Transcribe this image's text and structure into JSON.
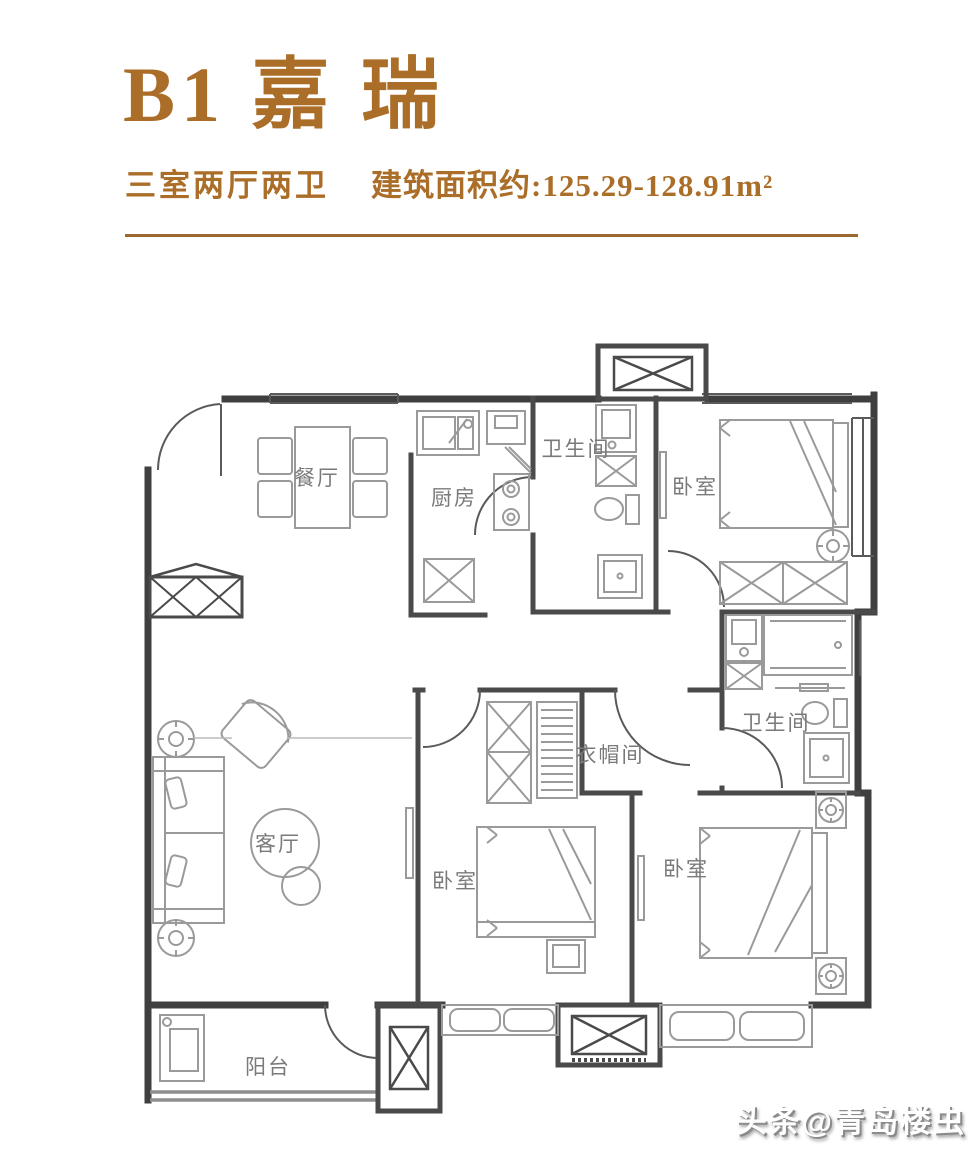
{
  "header": {
    "title": "B1 嘉 瑞",
    "layout_spec": "三室两厅两卫",
    "area_text": "建筑面积约:125.29-128.91m²"
  },
  "floorplan": {
    "rooms": [
      {
        "id": "dining",
        "label": "餐厅"
      },
      {
        "id": "kitchen",
        "label": "厨房"
      },
      {
        "id": "bathroom-1",
        "label": "卫生间"
      },
      {
        "id": "bedroom-1",
        "label": "卧室"
      },
      {
        "id": "living",
        "label": "客厅"
      },
      {
        "id": "closet",
        "label": "衣帽间"
      },
      {
        "id": "bathroom-2",
        "label": "卫生间"
      },
      {
        "id": "bedroom-2",
        "label": "卧室"
      },
      {
        "id": "bedroom-3",
        "label": "卧室"
      },
      {
        "id": "balcony",
        "label": "阳台"
      }
    ]
  },
  "watermark": {
    "text": "头条@青岛楼虫"
  },
  "colors": {
    "accent": "#ab6e28",
    "divider": "#9b6a30",
    "wall": "#3f3f3f",
    "inner_wall": "#4a4a4a",
    "furniture": "#9a9a9a",
    "room_label": "#7a7a7a",
    "watermark_shadow": "#8b8b8b"
  }
}
